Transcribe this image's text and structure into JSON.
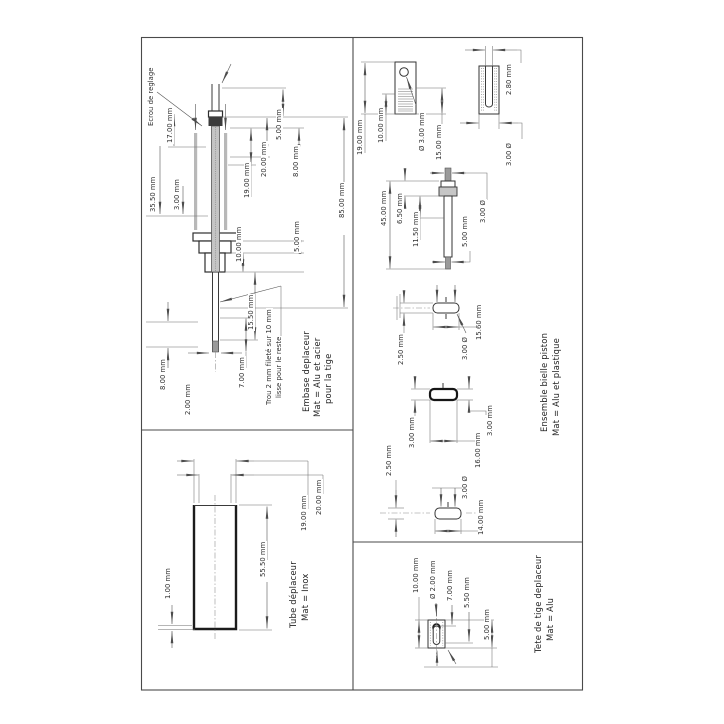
{
  "document_kind": "scanned technical drawing (rotated 90°)",
  "colors": {
    "paper": "#ffffff",
    "ink": "#3a3a3a",
    "dim_lines": "#6e6e6e"
  },
  "panels": {
    "embase": {
      "title": [
        "Embase deplaceur",
        "Mat = Alu et acier",
        "pour la tige"
      ],
      "note_arrow": "Ecrou de reglage",
      "hole_note": [
        "Trou 2 mm fileté sur 10 mm",
        "lisse pour le reste"
      ],
      "dims": [
        "17.00 mm",
        "35.50 mm",
        "3.00 mm",
        "19.00 mm",
        "20.00 mm",
        "5.00 mm",
        "8.00 mm",
        "85.00 mm",
        "8.00 mm",
        "10.00 mm",
        "5.00 mm",
        "15.50 mm",
        "7.00 mm",
        "2.00 mm"
      ]
    },
    "tube": {
      "title": [
        "Tube déplaceur",
        "Mat = Inox"
      ],
      "dims": [
        "1.00 mm",
        "55.50 mm",
        "19.00 mm",
        "20.00 mm"
      ]
    },
    "bielle": {
      "title": [
        "Ensemble bielle piston",
        "Mat = Alu et plastique"
      ],
      "dims": [
        "19.00 mm",
        "10.00 mm",
        "Ø 3.00 mm",
        "15.00 mm",
        "2.80 mm",
        "3.00 Ø",
        "45.00 mm",
        "6.50 mm",
        "11.50 mm",
        "3.00 Ø",
        "5.00 mm",
        "2.50 mm",
        "3.00 Ø",
        "15.60 mm",
        "3.00 mm",
        "3.00 mm",
        "16.00 mm",
        "2.50 mm",
        "3.00 Ø",
        "14.00 mm"
      ]
    },
    "tete": {
      "title": [
        "Tete de tige deplaceur",
        "Mat = Alu"
      ],
      "dims": [
        "10.00 mm",
        "Ø 2.00 mm",
        "7.00 mm",
        "5.50 mm",
        "5.00 mm"
      ]
    }
  }
}
